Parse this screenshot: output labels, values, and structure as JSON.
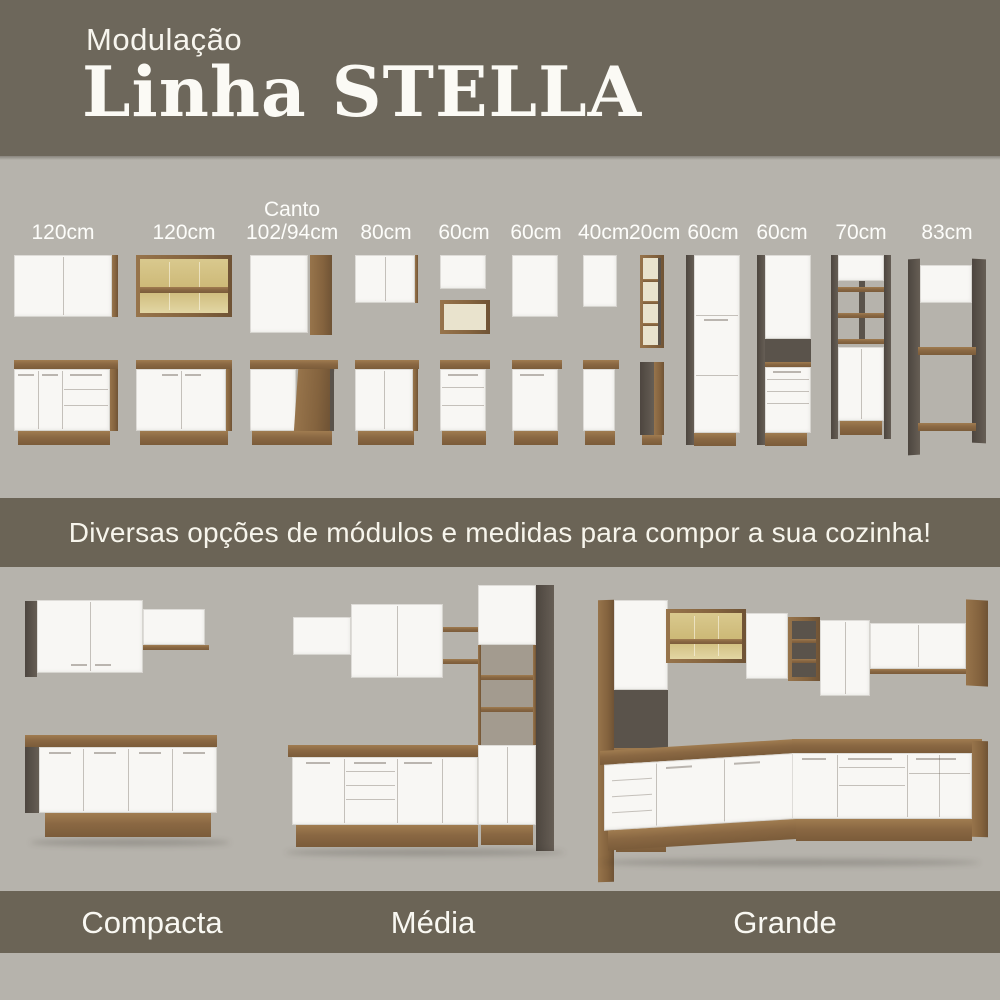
{
  "header": {
    "kicker": "Modulação",
    "title": "Linha STELLA"
  },
  "modules": {
    "items": [
      {
        "label": "120cm",
        "kind": "wall-cabinet-2-doors + base-doors-drawers"
      },
      {
        "label": "120cm",
        "kind": "glass-wall-cabinet + base-2-doors"
      },
      {
        "label_top": "Canto",
        "label": "102/94cm",
        "kind": "corner-wall-cabinet + corner-base"
      },
      {
        "label": "80cm",
        "kind": "wall-cabinet + base-2-doors"
      },
      {
        "label": "60cm",
        "kind": "wall-cabinet + open-niche + base-drawers"
      },
      {
        "label": "60cm",
        "kind": "wall-cabinet-1-door + base-1-door"
      },
      {
        "label": "40cm",
        "kind": "narrow-wall-cabinet + narrow-base"
      },
      {
        "label": "20cm",
        "kind": "open-shelf-column + narrow-base"
      },
      {
        "label": "60cm",
        "kind": "tall-pantry-3-doors"
      },
      {
        "label": "60cm",
        "kind": "tall-oven-tower-with-drawers"
      },
      {
        "label": "70cm",
        "kind": "tall-unit-open-shelves"
      },
      {
        "label": "83cm",
        "kind": "open-frame-tower"
      }
    ]
  },
  "banner": {
    "text": "Diversas opções de módulos e medidas para compor a sua cozinha!"
  },
  "kitchens": {
    "items": [
      {
        "name": "Compacta"
      },
      {
        "name": "Média"
      },
      {
        "name": "Grande"
      }
    ]
  },
  "colors": {
    "band": "#6B6456",
    "header": "#6D675B",
    "background": "#B6B3AC",
    "cabinet_white": "#F8F7F4",
    "wood": "#8A6843",
    "side_dark": "#59524B",
    "glass_amber": "#D8C88E",
    "text": "#F9F8F2"
  }
}
